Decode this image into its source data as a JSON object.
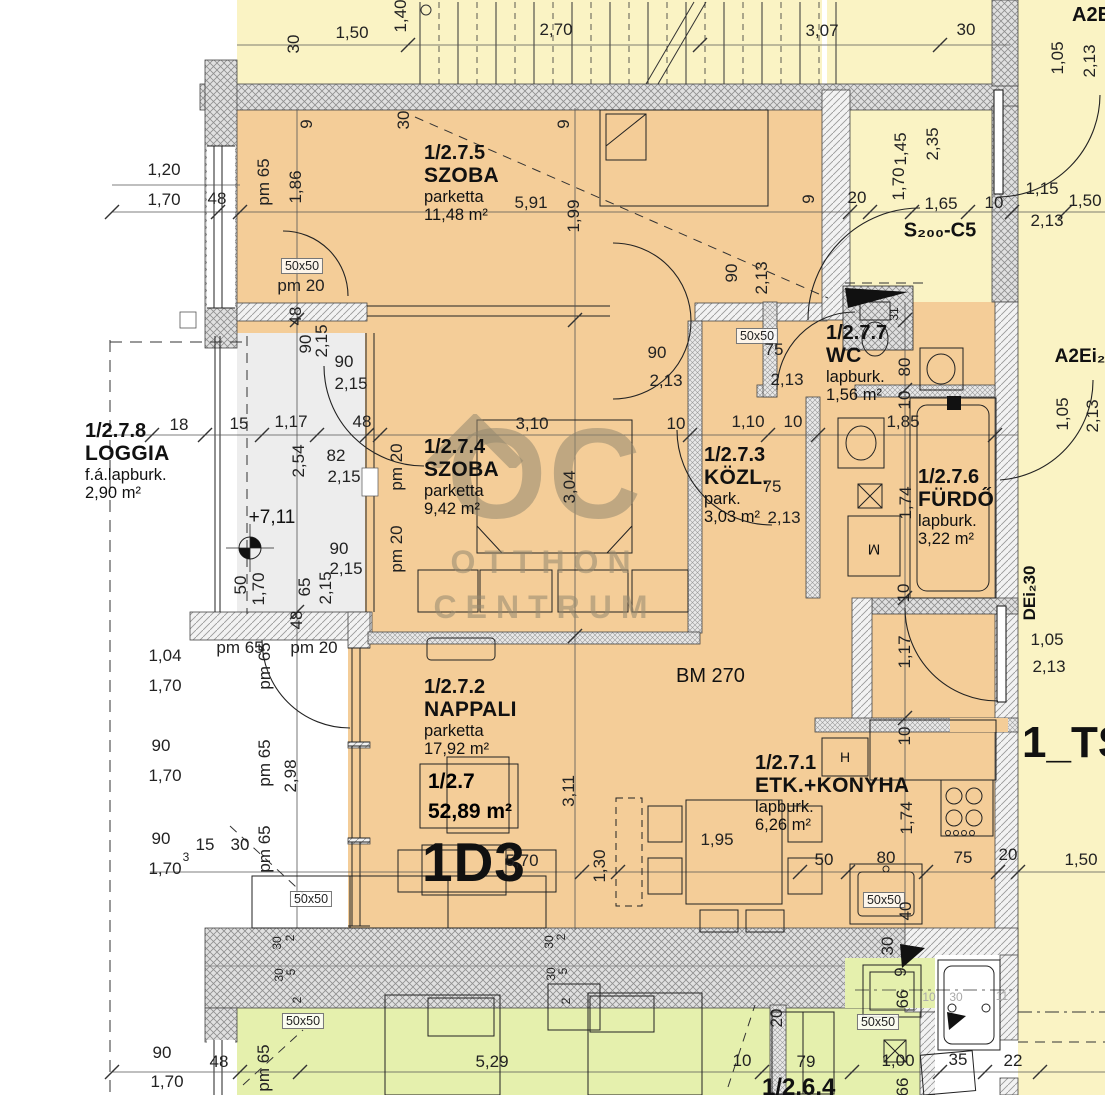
{
  "unit": {
    "code": "1/2.7",
    "area": "52,89 m²",
    "type": "1D3"
  },
  "rooms": [
    {
      "id": "1/2.7.5",
      "name": "SZOBA",
      "floor": "parketta",
      "area": "11,48 m²"
    },
    {
      "id": "1/2.7.8",
      "name": "LOGGIA",
      "floor": "f.á.lapburk.",
      "area": "2,90 m²"
    },
    {
      "id": "1/2.7.4",
      "name": "SZOBA",
      "floor": "parketta",
      "area": "9,42 m²"
    },
    {
      "id": "1/2.7.3",
      "name": "KÖZL.",
      "floor": "park.",
      "area": "3,03 m²"
    },
    {
      "id": "1/2.7.7",
      "name": "WC",
      "floor": "lapburk.",
      "area": "1,56 m²"
    },
    {
      "id": "1/2.7.6",
      "name": "FÜRDŐ",
      "floor": "lapburk.",
      "area": "3,22 m²"
    },
    {
      "id": "1/2.7.2",
      "name": "NAPPALI",
      "floor": "parketta",
      "area": "17,92 m²"
    },
    {
      "id": "1/2.7.1",
      "name": "ETK.+KONYHA",
      "floor": "lapburk.",
      "area": "6,26 m²"
    }
  ],
  "labels": {
    "bm": "BM 270",
    "level": "+7,11",
    "stair_core": "S₂₀₀-C5",
    "neighbor_top": "A2E",
    "neighbor_right": "A2Ei₂",
    "entry_door": "DEi₂30",
    "sheet": "1_TS",
    "unit_below": "1/2.6.4",
    "shaft": "50x50",
    "washer": "M",
    "hood": "H"
  },
  "watermark": {
    "logo": "OC",
    "line1": "OTTHON",
    "line2": "CENTRUM"
  },
  "colors": {
    "apartment_floor": "#f4cd98",
    "neighbor_floor": "#faf3c4",
    "unit_below_floor": "#e5f0ad",
    "loggia_floor": "#ededed"
  },
  "dims": [
    "1,50",
    "1,40",
    "2,70",
    "3,07",
    "30",
    "30",
    "1,05",
    "2,13",
    "9",
    "30",
    "9",
    "1,20",
    "1,70",
    "48",
    "pm 65",
    "1,86",
    "5,91",
    "1,99",
    "9",
    "20",
    "1,45",
    "2,35",
    "1,70",
    "1,65",
    "10",
    "1,15",
    "1,50",
    "2,13",
    "90",
    "2,13",
    "pm 20",
    "48",
    "90",
    "2,15",
    "90",
    "2,15",
    "18",
    "15",
    "1,17",
    "48",
    "2,54",
    "82",
    "2,15",
    "pm 20",
    "pm 20",
    "3,10",
    "10",
    "1,10",
    "10",
    "1,85",
    "3,04",
    "90",
    "2,13",
    "75",
    "2,13",
    "80",
    "10",
    "1,74",
    "90",
    "2,15",
    "50",
    "1,70",
    "65",
    "2,15",
    "48",
    "1,05",
    "2,13",
    "75",
    "2,13",
    "1,04",
    "1,70",
    "pm 65",
    "pm 20",
    "pm 65",
    "90",
    "1,70",
    "pm 65",
    "2,98",
    "90",
    "1,70",
    "15",
    "30",
    "3",
    "pm 65",
    "10",
    "1,17",
    "1,05",
    "2,13",
    "10",
    "3,11",
    "5,70",
    "1,30",
    "1,95",
    "1,74",
    "50",
    "80",
    "75",
    "20",
    "1,50",
    "40",
    "30",
    "2",
    "30",
    "5",
    "30",
    "2",
    "30",
    "5",
    "30",
    "2",
    "2",
    "20",
    "9",
    "66",
    "10",
    "30",
    "11",
    "90",
    "1,70",
    "48",
    "pm 65",
    "5,29",
    "79",
    "1,00",
    "35",
    "22",
    "66",
    "10",
    "31"
  ]
}
